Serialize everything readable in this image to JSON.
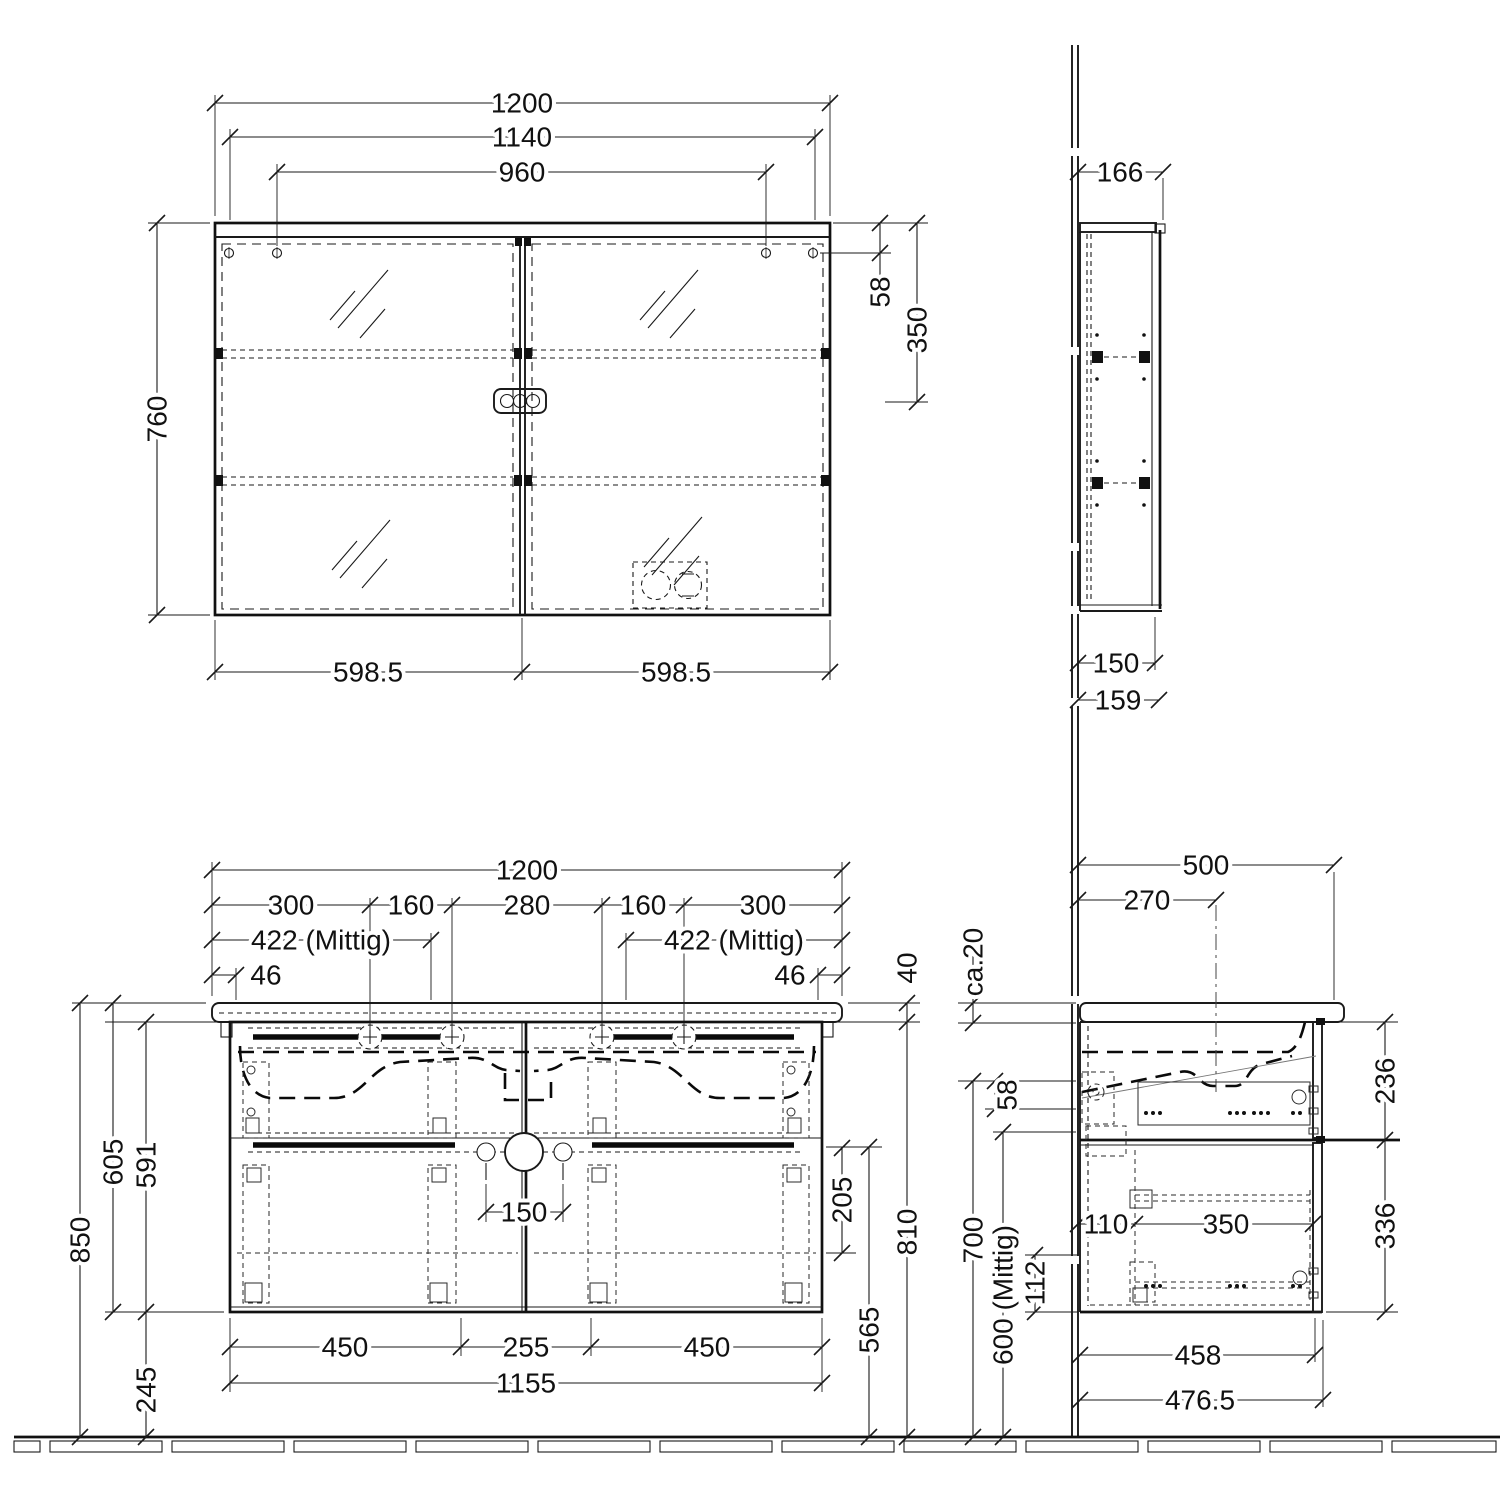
{
  "drawing": {
    "kind": "technical-dimension-drawing",
    "mirror_front": {
      "w_total": "1200",
      "w_inner": "1140",
      "w_screws": "960",
      "height": "760",
      "screw_top": "58",
      "shelf_top": "350",
      "door_left": "598.5",
      "door_right": "598.5"
    },
    "mirror_side": {
      "d_total": "166",
      "d_body": "150",
      "d_door": "159"
    },
    "vanity_front": {
      "w_total": "1200",
      "chain": [
        "300",
        "160",
        "280",
        "160",
        "300"
      ],
      "tap_left": "422 (Mittig)",
      "tap_right": "422 (Mittig)",
      "edge_left": "46",
      "edge_right": "46",
      "basin_thickness": "40",
      "h_total": "850",
      "h_basin_to_bottom": "605",
      "h_cabinet": "591",
      "h_floor_clearance": "245",
      "d_drawer_upper": "205",
      "h_divider_floor": "565",
      "h_underside": "810",
      "drain_gap": "150",
      "bottom_left": "450",
      "bottom_center": "255",
      "bottom_right": "450",
      "bottom_total": "1155"
    },
    "vanity_side": {
      "d_total": "500",
      "tap_center": "270",
      "top_gap": "ca.20",
      "gap_58": "58",
      "h_clearance": "700",
      "drain_height": "600 (Mittig)",
      "pipe_offset": "112",
      "back_offset": "110",
      "rail_length": "350",
      "inner_upper": "236",
      "inner_lower": "336",
      "d_body": "458",
      "d_with_front": "476.5"
    }
  }
}
